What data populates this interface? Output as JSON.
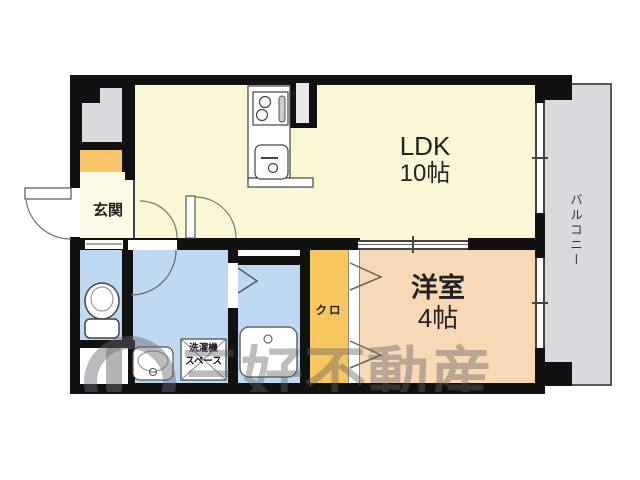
{
  "title": "floor-plan",
  "colors": {
    "wall": "#111111",
    "ldk": "#FAF6D6",
    "genkan": "#FCFAE6",
    "bedroom": "#F9D8B6",
    "closet": "#F6C75F",
    "shoebox": "#F8C46A",
    "wet": "#BFD9F2",
    "balcony": "#DBD9DE",
    "ps": "#DBD9DE"
  },
  "rooms": {
    "ldk": {
      "name": "LDK",
      "size": "10帖"
    },
    "bedroom": {
      "name": "洋室",
      "size": "4帖"
    },
    "entrance": {
      "label": "玄関"
    },
    "closet": {
      "label": "クロ"
    },
    "balcony": {
      "label": "バルコニー"
    },
    "laundry": {
      "line1": "洗濯機",
      "line2": "スペース"
    }
  },
  "watermark": {
    "text": "三好不動産"
  }
}
